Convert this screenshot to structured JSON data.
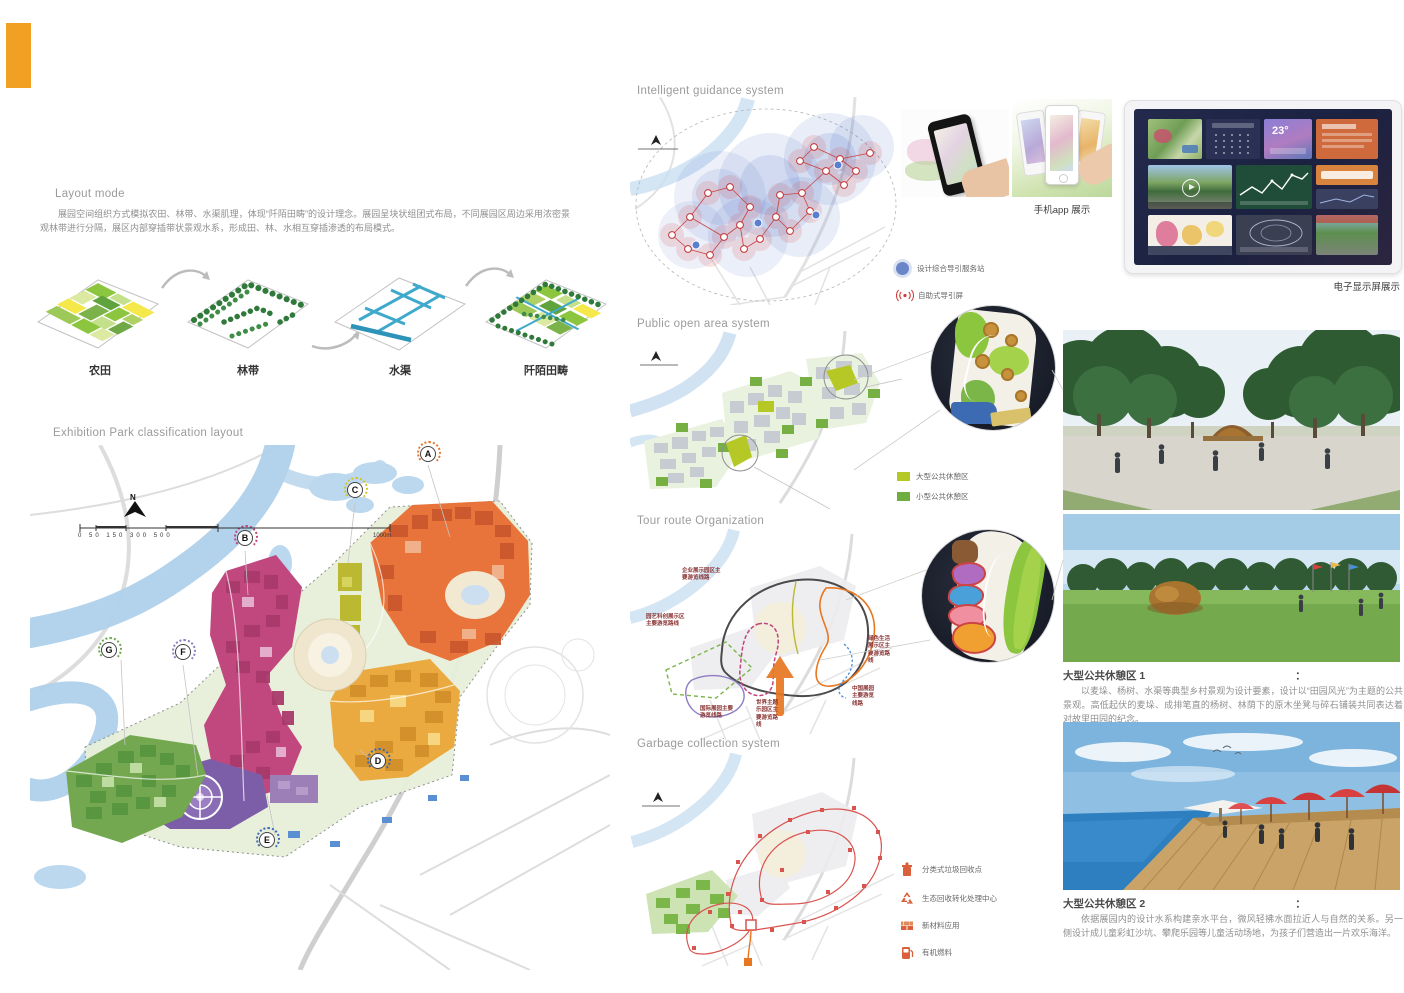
{
  "colors": {
    "accent_orange": "#F2A024",
    "zone_orange": "#E8743B",
    "zone_amber": "#EBAA3F",
    "zone_magenta": "#C0487F",
    "zone_purple": "#7B5EA7",
    "zone_green": "#74A850",
    "zone_olive": "#BBB832",
    "water_blue": "#AFD0EA",
    "route_red": "#D9534F",
    "legend_large_rest": "#B5C826",
    "legend_small_rest": "#6FAE3E"
  },
  "layout_mode": {
    "title": "Layout mode",
    "body": "展园空间组织方式模拟农田、林带、水渠肌理，体现“阡陌田畴”的设计理念。展园呈块状组团式布局，不同展园区周边采用浓密景观林带进行分隔，展区内部穿插带状景观水系，形成田、林、水相互穿插渗透的布局模式。",
    "steps": [
      {
        "label": "农田"
      },
      {
        "label": "林带"
      },
      {
        "label": "水渠"
      },
      {
        "label": "阡陌田畴"
      }
    ]
  },
  "classification": {
    "title": "Exhibition Park classification layout",
    "north_label": "N",
    "scale_ticks": "0  50  150  300   500",
    "scale_end_label": "1000m",
    "markers": [
      "A",
      "B",
      "C",
      "D",
      "E",
      "F",
      "G"
    ]
  },
  "guidance": {
    "title": "Intelligent guidance system",
    "legend": [
      {
        "icon": "guide-station",
        "label": "设计综合导引服务站"
      },
      {
        "icon": "wireless-screen",
        "label": "自助式导引屏"
      }
    ],
    "phone_caption": "手机app 展示",
    "screen_caption": "电子显示屏展示",
    "tablet_temp": "23°"
  },
  "public_area": {
    "title": "Public open area system",
    "legend": [
      {
        "label": "大型公共休憩区",
        "color": "#B5C826"
      },
      {
        "label": "小型公共休憩区",
        "color": "#6FAE3E"
      }
    ]
  },
  "tour_route": {
    "title": "Tour route Organization",
    "labels": [
      "企业展示园区主要游览线路",
      "园艺科创展示区主要游览路线",
      "绿色生活展示区主要游览路线",
      "中国展园主要游览线路",
      "国际展园主要游览线路",
      "世界主题乐园区主要游览路线"
    ]
  },
  "garbage": {
    "title": "Garbage collection system",
    "legend": [
      {
        "icon": "trash-bin",
        "label": "分类式垃圾回收点"
      },
      {
        "icon": "recycle",
        "label": "生态回收转化处理中心"
      },
      {
        "icon": "bricks",
        "label": "新材料应用"
      },
      {
        "icon": "fuel",
        "label": "有机燃料"
      }
    ]
  },
  "rest_areas": [
    {
      "heading": "大型公共休憩区 1",
      "colon": "：",
      "body": "以麦垛、杨树、水渠等典型乡村景观为设计要素，设计以“田园风光”为主题的公共景观。高低起伏的麦垛、成排笔直的杨树、林荫下的原木坐凳与碎石铺装共同表达着对故里田园的纪念。"
    },
    {
      "heading": "大型公共休憩区 2",
      "colon": "：",
      "body": "依据展园内的设计水系构建亲水平台，微风轻拂水面拉近人与自然的关系。另一侧设计成儿童彩虹沙坑、攀爬乐园等儿童活动场地，为孩子们营造出一片欢乐海洋。"
    }
  ]
}
